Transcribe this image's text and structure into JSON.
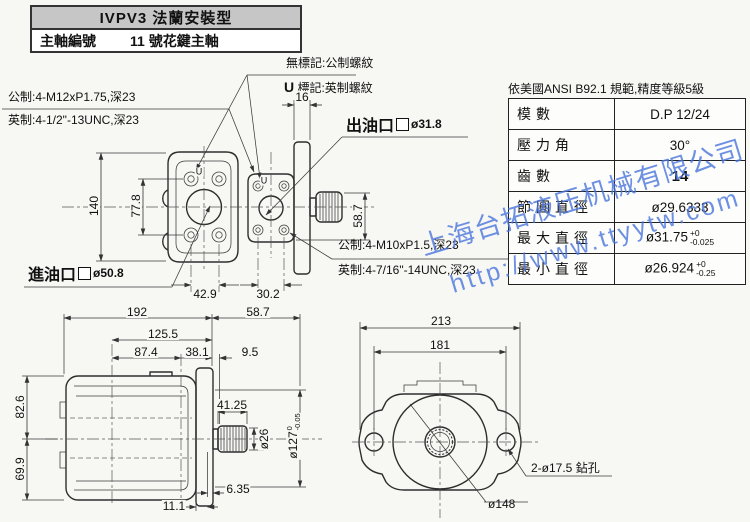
{
  "header": {
    "title": "IVPV3 法蘭安裝型",
    "spindle_label": "主軸編號",
    "spindle_value": "11 號花鍵主軸"
  },
  "notes": {
    "line1": "無標記:公制螺紋",
    "u_prefix": "U",
    "line2_rest": "標記:英制螺紋"
  },
  "front_thread": {
    "metric": "公制:4-M12xP1.75,深23",
    "imperial": "英制:4-1/2\"-13UNC,深23"
  },
  "rear_thread": {
    "metric": "公制:4-M10xP1.5,深23",
    "imperial": "英制:4-7/16\"-14UNC,深23"
  },
  "ports": {
    "outlet_label": "出油口",
    "outlet_size": "ø31.8",
    "inlet_label": "進油口",
    "inlet_size": "ø50.8"
  },
  "spline_table": {
    "standard_note": "依美國ANSI B92.1 規範,精度等級5級",
    "rows": [
      {
        "label": "模數",
        "value": "D.P 12/24"
      },
      {
        "label": "壓力角",
        "value": "30°"
      },
      {
        "label": "齒數",
        "value": "14"
      },
      {
        "label": "節圓直徑",
        "value": "ø29.6333"
      },
      {
        "label": "最大直徑",
        "value": "ø31.75",
        "tol_top": "+0",
        "tol_bottom": "-0.025"
      },
      {
        "label": "最小直徑",
        "value": "ø26.924",
        "tol_top": "+0",
        "tol_bottom": "-0.25"
      }
    ]
  },
  "watermark": {
    "company": "上海台拓液压机械有限公司",
    "url": "http://www.ttyytw.com",
    "color": "#4a76dd"
  },
  "dimensions": {
    "front_view": {
      "height": "140",
      "bolt_v": "77.8",
      "bolt_w": "42.9",
      "u_mark": "U"
    },
    "side_view": {
      "flange_t": "16",
      "shaft_h": "58.7",
      "bolt_w": "30.2",
      "u_mark": "U"
    },
    "profile_view": {
      "total_len": "192",
      "shaft_ext": "58.7",
      "sub_len": "125.5",
      "seg1": "87.4",
      "seg2": "38.1",
      "seg3": "9.5",
      "h_top": "82.6",
      "h_bottom": "69.9",
      "spline_len": "41.25",
      "shaft_dia": "ø26",
      "pilot_dia": "ø127",
      "pilot_tol_top": "0",
      "pilot_tol_bottom": "-0.05",
      "off_small": "6.35",
      "off_large": "11.1"
    },
    "flange_view": {
      "width": "213",
      "bolt_span": "181",
      "drill_note": "2-ø17.5 鉆孔",
      "bolt_circle": "ø148"
    }
  }
}
